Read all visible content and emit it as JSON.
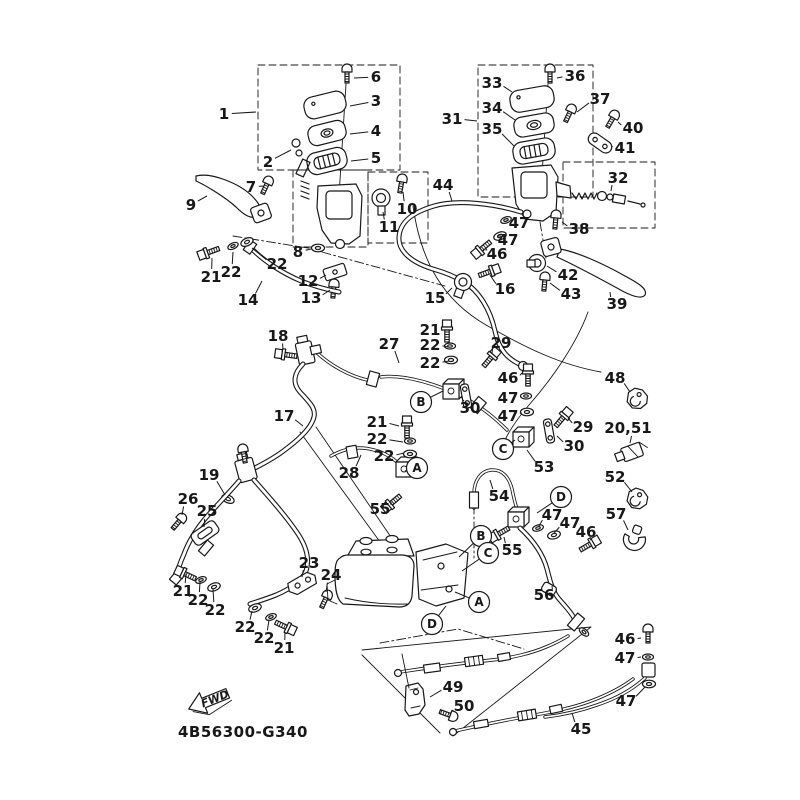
{
  "diagram": {
    "part_code": "4B56300-G340",
    "fwd_label": "FWD",
    "ink_color": "#181818",
    "background_color": "#ffffff",
    "callouts": [
      {
        "t": "1",
        "x": 224,
        "y": 114,
        "tx": 256,
        "ty": 112
      },
      {
        "t": "6",
        "x": 376,
        "y": 77,
        "tx": 354,
        "ty": 78
      },
      {
        "t": "3",
        "x": 376,
        "y": 101,
        "tx": 350,
        "ty": 106
      },
      {
        "t": "4",
        "x": 376,
        "y": 131,
        "tx": 350,
        "ty": 134
      },
      {
        "t": "5",
        "x": 376,
        "y": 158,
        "tx": 351,
        "ty": 161
      },
      {
        "t": "2",
        "x": 268,
        "y": 162,
        "tx": 291,
        "ty": 150
      },
      {
        "t": "7",
        "x": 251,
        "y": 187,
        "tx": 264,
        "ty": 186
      },
      {
        "t": "9",
        "x": 191,
        "y": 205,
        "tx": 207,
        "ty": 196
      },
      {
        "t": "10",
        "x": 407,
        "y": 209,
        "tx": 403,
        "ty": 192
      },
      {
        "t": "11",
        "x": 389,
        "y": 227,
        "tx": 383,
        "ty": 212
      },
      {
        "t": "8",
        "x": 298,
        "y": 252,
        "tx": 311,
        "ty": 249
      },
      {
        "t": "21",
        "x": 211,
        "y": 277,
        "tx": 212,
        "ty": 258
      },
      {
        "t": "22",
        "x": 231,
        "y": 272,
        "tx": 233,
        "ty": 252
      },
      {
        "t": "22",
        "x": 277,
        "y": 264,
        "tx": 252,
        "ty": 248
      },
      {
        "t": "14",
        "x": 248,
        "y": 300,
        "tx": 262,
        "ty": 281
      },
      {
        "t": "12",
        "x": 308,
        "y": 281,
        "tx": 326,
        "ty": 275
      },
      {
        "t": "13",
        "x": 311,
        "y": 298,
        "tx": 330,
        "ty": 290
      },
      {
        "t": "33",
        "x": 492,
        "y": 83,
        "tx": 512,
        "ty": 92
      },
      {
        "t": "36",
        "x": 575,
        "y": 76,
        "tx": 557,
        "ty": 78
      },
      {
        "t": "34",
        "x": 492,
        "y": 108,
        "tx": 515,
        "ty": 120
      },
      {
        "t": "37",
        "x": 600,
        "y": 99,
        "tx": 577,
        "ty": 112
      },
      {
        "t": "31",
        "x": 452,
        "y": 119,
        "tx": 477,
        "ty": 121
      },
      {
        "t": "40",
        "x": 633,
        "y": 128,
        "tx": 618,
        "ty": 122
      },
      {
        "t": "35",
        "x": 492,
        "y": 129,
        "tx": 514,
        "ty": 146
      },
      {
        "t": "41",
        "x": 625,
        "y": 148,
        "tx": 612,
        "ty": 146
      },
      {
        "t": "32",
        "x": 618,
        "y": 178,
        "tx": 611,
        "ty": 191
      },
      {
        "t": "44",
        "x": 443,
        "y": 185,
        "tx": 452,
        "ty": 201
      },
      {
        "t": "47",
        "x": 519,
        "y": 223,
        "tx": 507,
        "ty": 220
      },
      {
        "t": "38",
        "x": 579,
        "y": 229,
        "tx": 562,
        "ty": 222
      },
      {
        "t": "47",
        "x": 508,
        "y": 240,
        "tx": 501,
        "ty": 236
      },
      {
        "t": "46",
        "x": 497,
        "y": 254,
        "tx": 487,
        "ty": 249
      },
      {
        "t": "42",
        "x": 568,
        "y": 275,
        "tx": 547,
        "ty": 266
      },
      {
        "t": "43",
        "x": 571,
        "y": 294,
        "tx": 550,
        "ty": 283
      },
      {
        "t": "39",
        "x": 617,
        "y": 304,
        "tx": 610,
        "ty": 292
      },
      {
        "t": "18",
        "x": 278,
        "y": 336,
        "tx": 283,
        "ty": 349
      },
      {
        "t": "27",
        "x": 389,
        "y": 344,
        "tx": 399,
        "ty": 363
      },
      {
        "t": "21",
        "x": 430,
        "y": 330,
        "tx": 445,
        "ty": 330
      },
      {
        "t": "22",
        "x": 430,
        "y": 345,
        "tx": 448,
        "ty": 347
      },
      {
        "t": "29",
        "x": 501,
        "y": 343,
        "tx": 492,
        "ty": 353
      },
      {
        "t": "22",
        "x": 430,
        "y": 363,
        "tx": 449,
        "ty": 361
      },
      {
        "t": "15",
        "x": 435,
        "y": 298,
        "tx": 452,
        "ty": 288
      },
      {
        "t": "16",
        "x": 505,
        "y": 289,
        "tx": 490,
        "ty": 275
      },
      {
        "t": "46",
        "x": 508,
        "y": 378,
        "tx": 522,
        "ty": 373
      },
      {
        "t": "47",
        "x": 508,
        "y": 398,
        "tx": 521,
        "ty": 396
      },
      {
        "t": "30",
        "x": 470,
        "y": 408,
        "tx": 464,
        "ty": 400
      },
      {
        "t": "47",
        "x": 508,
        "y": 416,
        "tx": 521,
        "ty": 412
      },
      {
        "t": "29",
        "x": 583,
        "y": 427,
        "tx": 568,
        "ty": 418
      },
      {
        "t": "30",
        "x": 574,
        "y": 446,
        "tx": 557,
        "ty": 436
      },
      {
        "t": "48",
        "x": 615,
        "y": 378,
        "tx": 630,
        "ty": 392
      },
      {
        "t": "20,51",
        "x": 628,
        "y": 428,
        "tx": 630,
        "ty": 443
      },
      {
        "t": "53",
        "x": 544,
        "y": 467,
        "tx": 527,
        "ty": 450
      },
      {
        "t": "52",
        "x": 615,
        "y": 477,
        "tx": 632,
        "ty": 492
      },
      {
        "t": "57",
        "x": 616,
        "y": 514,
        "tx": 628,
        "ty": 530
      },
      {
        "t": "47",
        "x": 552,
        "y": 515,
        "tx": 539,
        "ty": 526
      },
      {
        "t": "47",
        "x": 570,
        "y": 523,
        "tx": 554,
        "ty": 533
      },
      {
        "t": "46",
        "x": 586,
        "y": 532,
        "tx": 590,
        "ty": 540
      },
      {
        "t": "17",
        "x": 284,
        "y": 416,
        "tx": 303,
        "ty": 426
      },
      {
        "t": "21",
        "x": 377,
        "y": 422,
        "tx": 399,
        "ty": 426
      },
      {
        "t": "22",
        "x": 377,
        "y": 439,
        "tx": 403,
        "ty": 442
      },
      {
        "t": "22",
        "x": 384,
        "y": 456,
        "tx": 404,
        "ty": 453
      },
      {
        "t": "28",
        "x": 349,
        "y": 473,
        "tx": 361,
        "ty": 455
      },
      {
        "t": "55",
        "x": 380,
        "y": 509,
        "tx": 391,
        "ty": 502
      },
      {
        "t": "19",
        "x": 209,
        "y": 475,
        "tx": 225,
        "ty": 495
      },
      {
        "t": "26",
        "x": 188,
        "y": 499,
        "tx": 182,
        "ty": 515
      },
      {
        "t": "25",
        "x": 207,
        "y": 511,
        "tx": 204,
        "ty": 527
      },
      {
        "t": "54",
        "x": 499,
        "y": 496,
        "tx": 490,
        "ty": 480
      },
      {
        "t": "55",
        "x": 512,
        "y": 550,
        "tx": 504,
        "ty": 537
      },
      {
        "t": "56",
        "x": 544,
        "y": 595,
        "tx": 552,
        "ty": 586
      },
      {
        "t": "23",
        "x": 309,
        "y": 563,
        "tx": 302,
        "ty": 577
      },
      {
        "t": "24",
        "x": 331,
        "y": 575,
        "tx": 326,
        "ty": 592
      },
      {
        "t": "21",
        "x": 183,
        "y": 591,
        "tx": 186,
        "ty": 574
      },
      {
        "t": "22",
        "x": 198,
        "y": 600,
        "tx": 200,
        "ty": 582
      },
      {
        "t": "22",
        "x": 215,
        "y": 610,
        "tx": 213,
        "ty": 589
      },
      {
        "t": "22",
        "x": 245,
        "y": 627,
        "tx": 252,
        "ty": 611
      },
      {
        "t": "22",
        "x": 264,
        "y": 638,
        "tx": 269,
        "ty": 620
      },
      {
        "t": "21",
        "x": 284,
        "y": 648,
        "tx": 285,
        "ty": 632
      },
      {
        "t": "46",
        "x": 625,
        "y": 639,
        "tx": 641,
        "ty": 638
      },
      {
        "t": "47",
        "x": 625,
        "y": 658,
        "tx": 641,
        "ty": 657
      },
      {
        "t": "49",
        "x": 453,
        "y": 687,
        "tx": 430,
        "ty": 697
      },
      {
        "t": "50",
        "x": 464,
        "y": 706,
        "tx": 450,
        "ty": 714
      },
      {
        "t": "47",
        "x": 626,
        "y": 701,
        "tx": 645,
        "ty": 687
      },
      {
        "t": "45",
        "x": 581,
        "y": 729,
        "tx": 572,
        "ty": 713
      }
    ],
    "ref_letters": [
      {
        "t": "B",
        "x": 421,
        "y": 402,
        "tx": 443,
        "ty": 391
      },
      {
        "t": "C",
        "x": 503,
        "y": 449,
        "tx": 515,
        "ty": 440
      },
      {
        "t": "A",
        "x": 417,
        "y": 468,
        "tx": 405,
        "ty": 471
      },
      {
        "t": "D",
        "x": 561,
        "y": 497,
        "tx": 537,
        "ty": 513
      },
      {
        "t": "B",
        "x": 481,
        "y": 536,
        "tx": 459,
        "ty": 557
      },
      {
        "t": "C",
        "x": 488,
        "y": 553,
        "tx": 462,
        "ty": 571
      },
      {
        "t": "A",
        "x": 479,
        "y": 602,
        "tx": 455,
        "ty": 592
      },
      {
        "t": "D",
        "x": 432,
        "y": 624,
        "tx": 446,
        "ty": 606
      }
    ]
  }
}
